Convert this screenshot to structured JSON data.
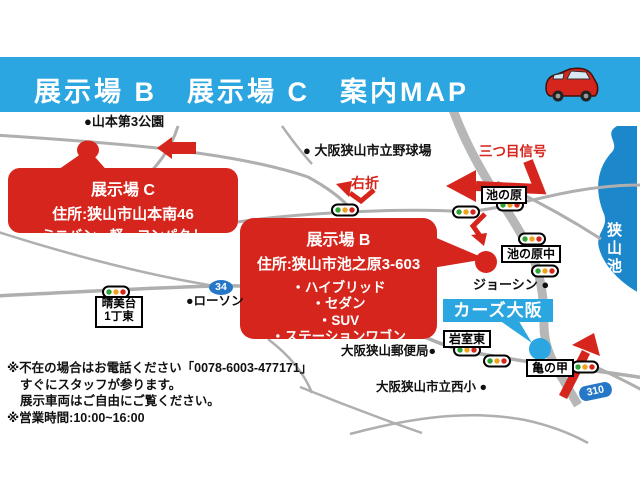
{
  "header": {
    "title": "展示場 B　展示場 C　案内MAP"
  },
  "map": {
    "labels": {
      "yamamoto_park": "●山本第3公園",
      "baseball_field": "● 大阪狭山市立野球場",
      "third_signal": "三つ目信号",
      "right_turn": "右折",
      "ikenohara": "池の原",
      "ikenohara_naka": "池の原中",
      "joshin": "ジョーシン ●",
      "cars_osaka": "カーズ大阪",
      "iwamuro_higashi": "岩室東",
      "post_office": "大阪狭山郵便局●",
      "nishi_elementary": "大阪狭山市立西小 ●",
      "kamenoko": "亀の甲",
      "harumidai_line1": "晴美台",
      "harumidai_line2": "1丁東",
      "lawson": "●ローソン",
      "route_34": "34",
      "route_310": "310",
      "sayama_lake": "狭山池"
    },
    "callout_c": {
      "title": "展示場 C",
      "address": "住所:狭山市山本南46",
      "cars": "ミニバン・軽・コンパクト"
    },
    "callout_b": {
      "title": "展示場 B",
      "address": "住所:狭山市池之原3-603",
      "car_types": [
        "・ハイブリッド",
        "・セダン",
        "・SUV",
        "・ステーションワゴン"
      ]
    }
  },
  "notes": {
    "line1": "※不在の場合はお電話ください「0078-6003-477171」",
    "line2": "すぐにスタッフが参ります。",
    "line3": "展示車両はご自由にご覧ください。",
    "line4": "※営業時間:10:00~16:00"
  },
  "colors": {
    "header_blue": "#2CA6E0",
    "lake_blue": "#1D87CC",
    "accent_red": "#D6251C",
    "road_gray": "#AFAFAF",
    "shield_blue": "#2577C8"
  }
}
